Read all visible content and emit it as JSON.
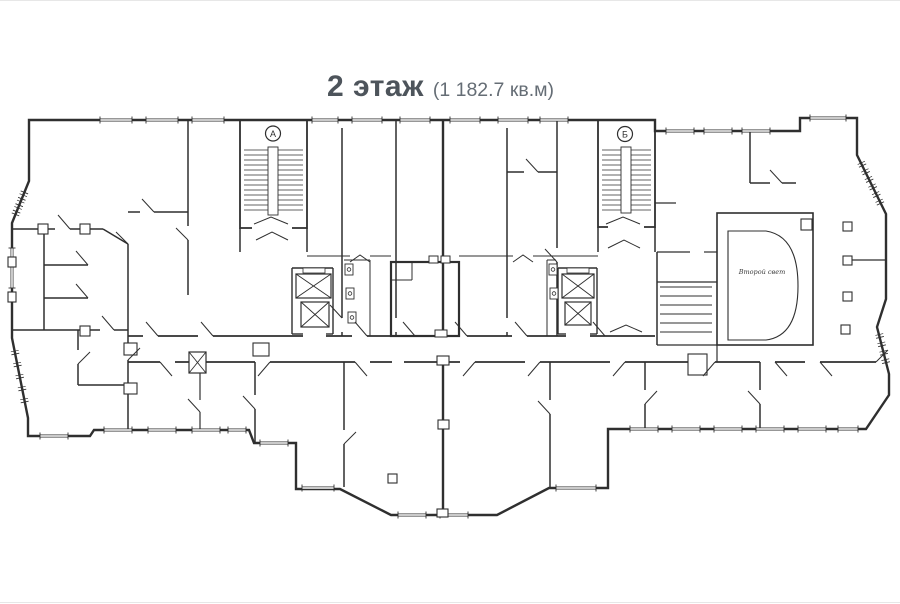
{
  "page": {
    "background": "#ffffff",
    "wall_color": "#2f2f2f",
    "light_wall_color": "#4a4a4a",
    "title_color": "#4d545b",
    "area_color": "#656d75"
  },
  "header": {
    "floor_label": "2 этаж",
    "area_label": "(1 182.7 кв.м)"
  },
  "plan": {
    "stairwell_a_label": "А",
    "stairwell_b_label": "Б",
    "second_light_label": "Второй свет"
  }
}
